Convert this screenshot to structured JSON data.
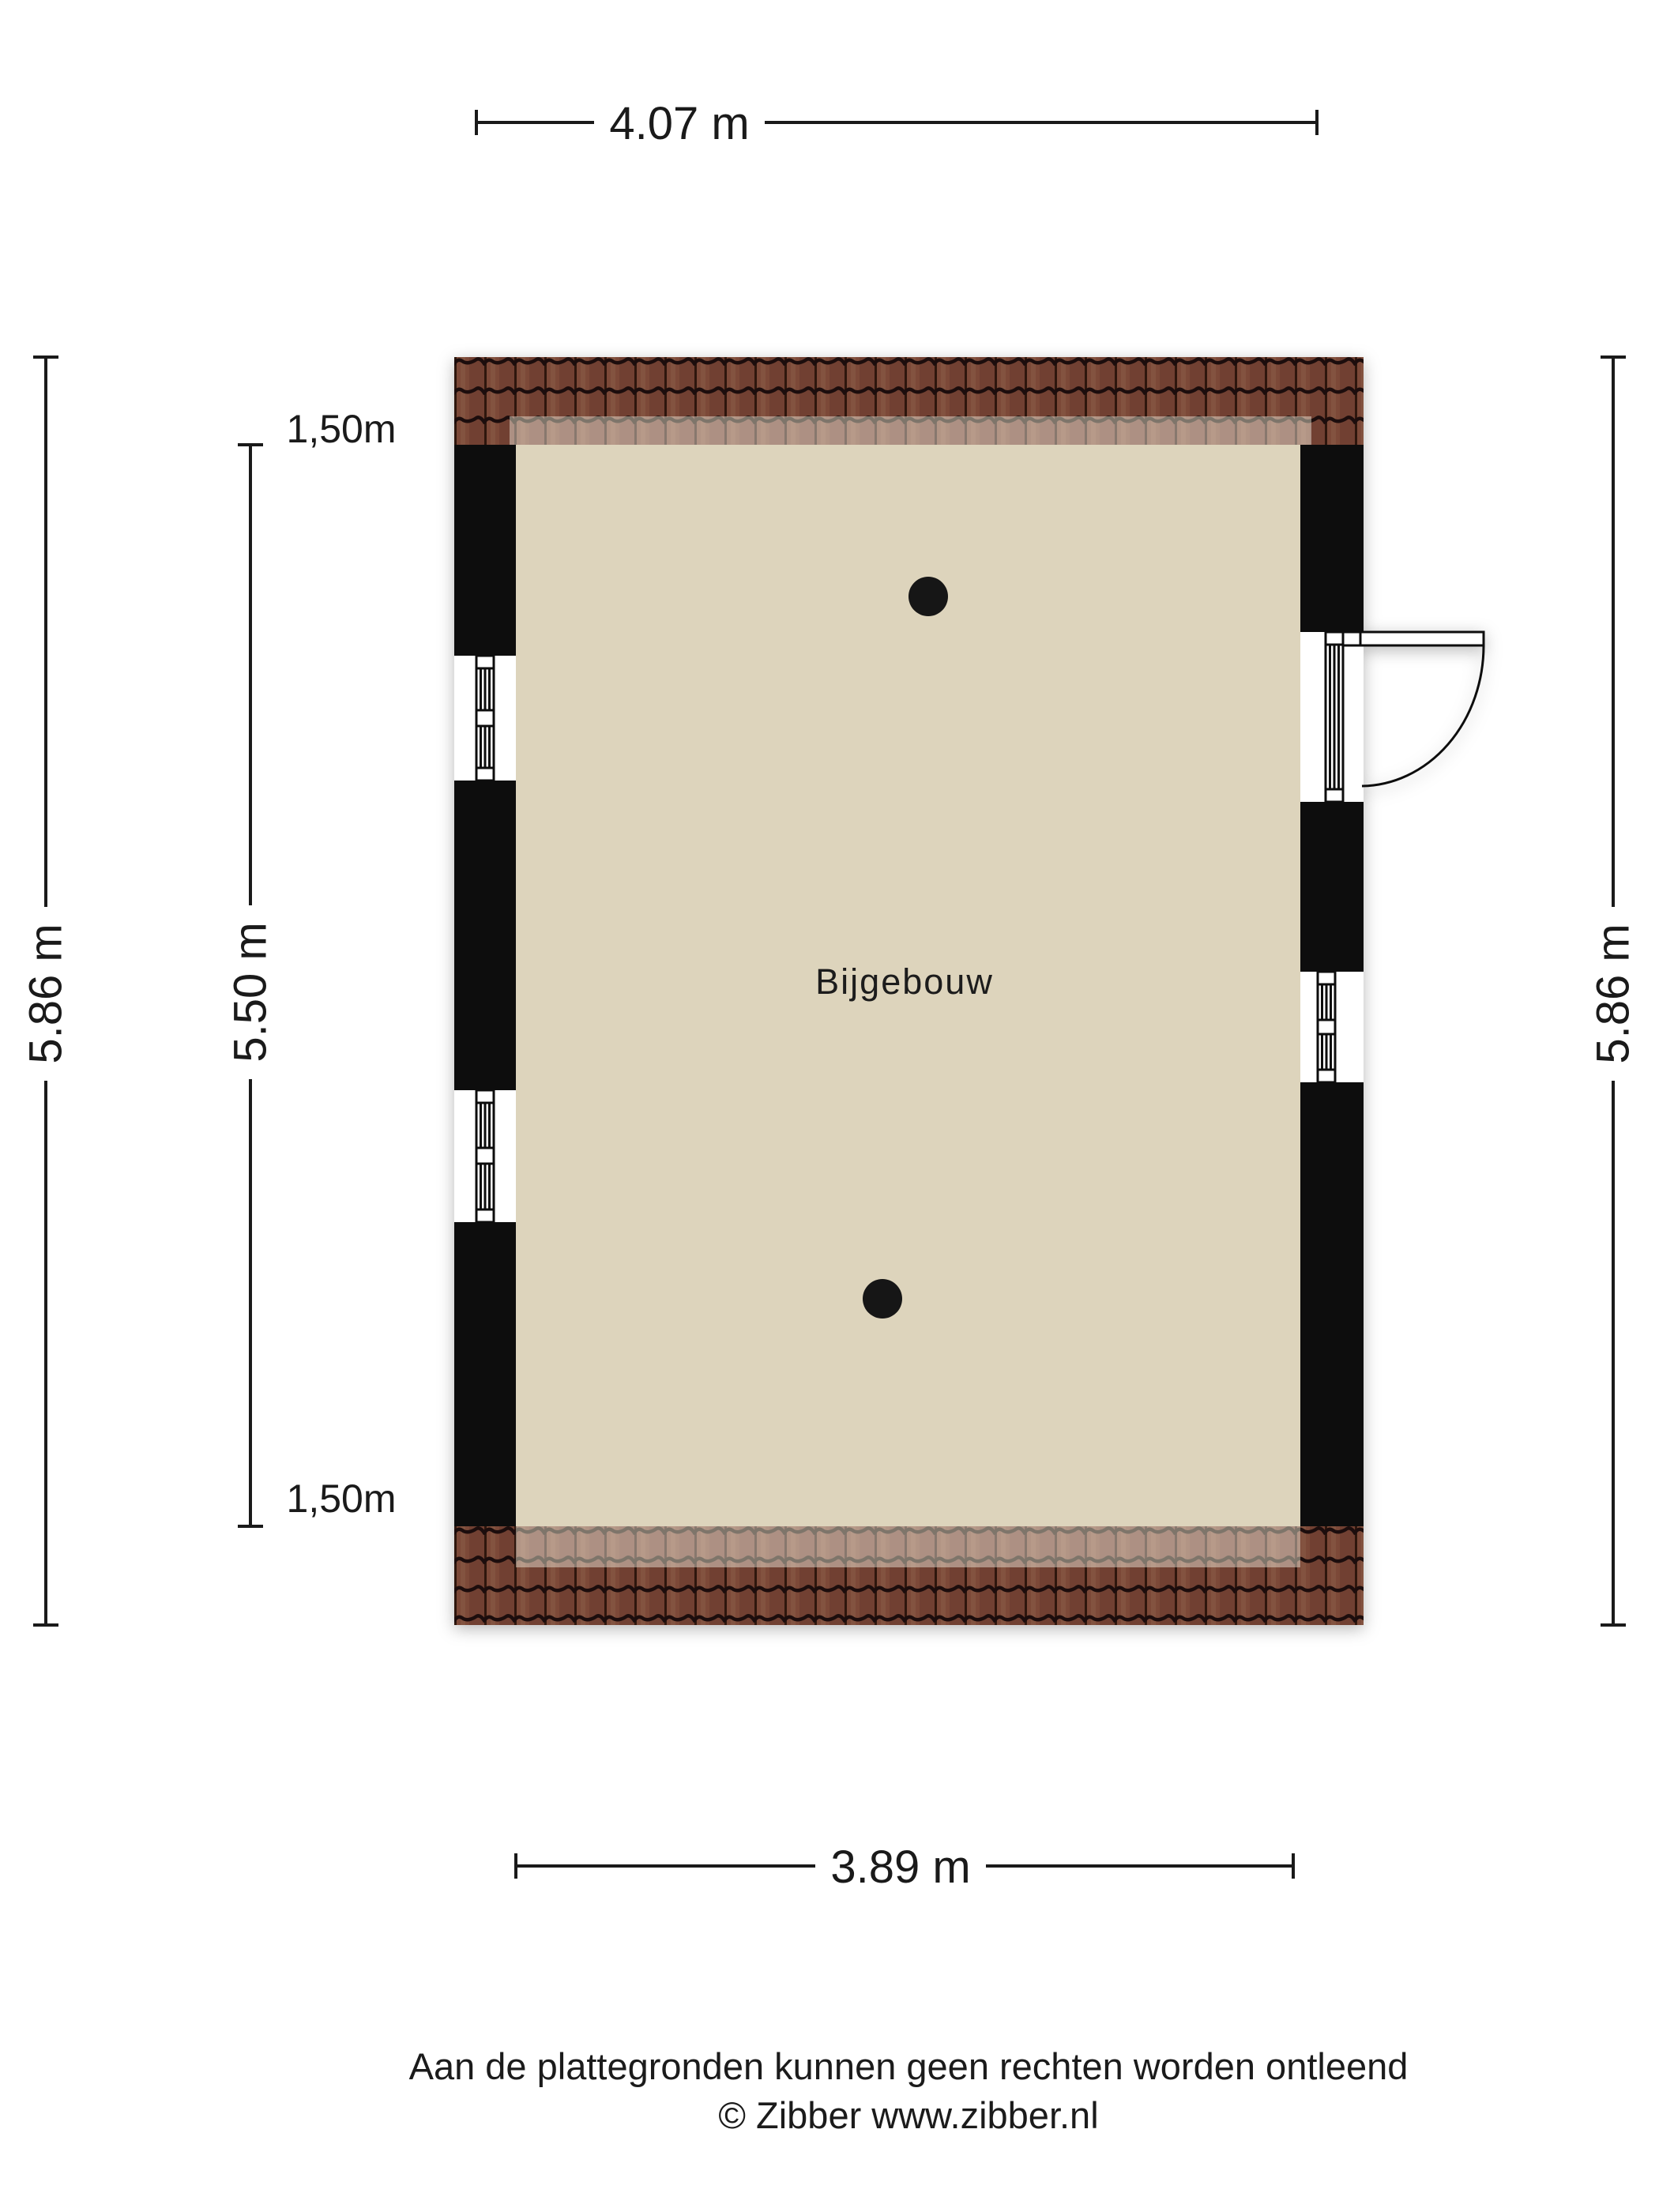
{
  "dimensions": {
    "top": "4.07 m",
    "bottom": "3.89 m",
    "left_outer": "5.86 m",
    "left_inner": "5.50 m",
    "right": "5.86 m",
    "clearance_top": "1,50m",
    "clearance_bottom": "1,50m"
  },
  "room": {
    "label": "Bijgebouw"
  },
  "footer": {
    "disclaimer": "Aan de plattegronden kunnen geen rechten worden ontleend",
    "credit": "© Zibber www.zibber.nl"
  },
  "colors": {
    "floor": "#DDD4BC",
    "wall": "#0A0A0A",
    "roof_tile": "#7B4A38",
    "roof_tile_dark": "#1C0D08",
    "dimension_line": "#1A1A1A"
  }
}
